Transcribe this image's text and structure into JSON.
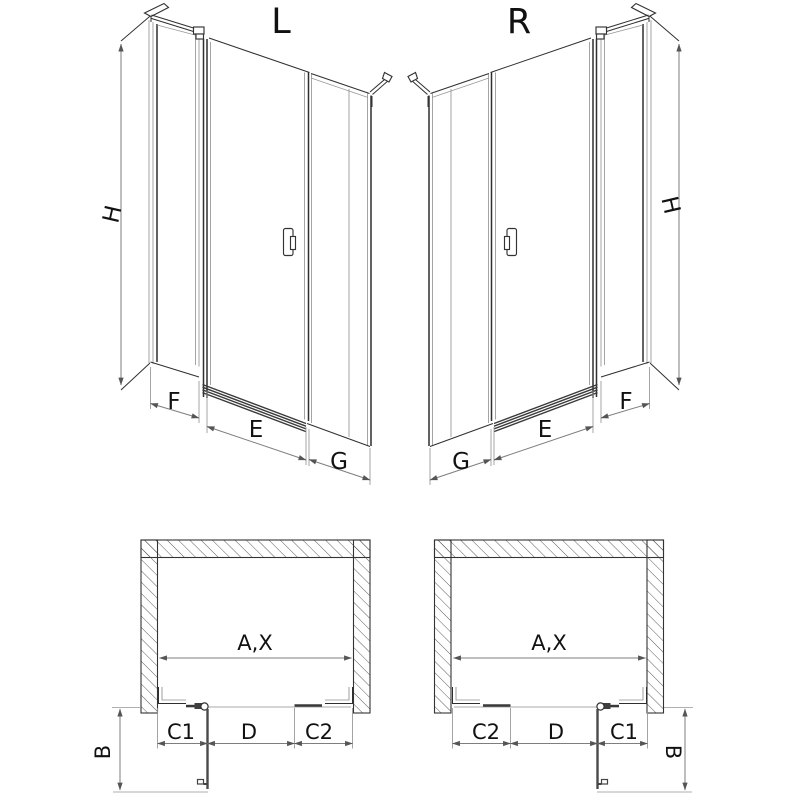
{
  "diagram": {
    "type": "technical-drawing",
    "subject": "shower enclosure with hinged door and side panel, left (L) and right (R) versions",
    "views": [
      "perspective-left",
      "perspective-right",
      "plan-left",
      "plan-right"
    ]
  },
  "labels": {
    "persp_left": {
      "title": "L",
      "h": "H",
      "f": "F",
      "e": "E",
      "g": "G"
    },
    "persp_right": {
      "title": "R",
      "h": "H",
      "f": "F",
      "e": "E",
      "g": "G"
    },
    "plan_left": {
      "ax": "A,X",
      "c1": "C1",
      "d": "D",
      "c2": "C2",
      "b": "B"
    },
    "plan_right": {
      "ax": "A,X",
      "c1": "C1",
      "d": "D",
      "c2": "C2",
      "b": "B"
    }
  },
  "colors": {
    "background": "#ffffff",
    "line_dark": "#2f2f2f",
    "line_light": "#9a9a9a",
    "dimension_line": "#7e7e7e",
    "label_text": "#111111"
  }
}
